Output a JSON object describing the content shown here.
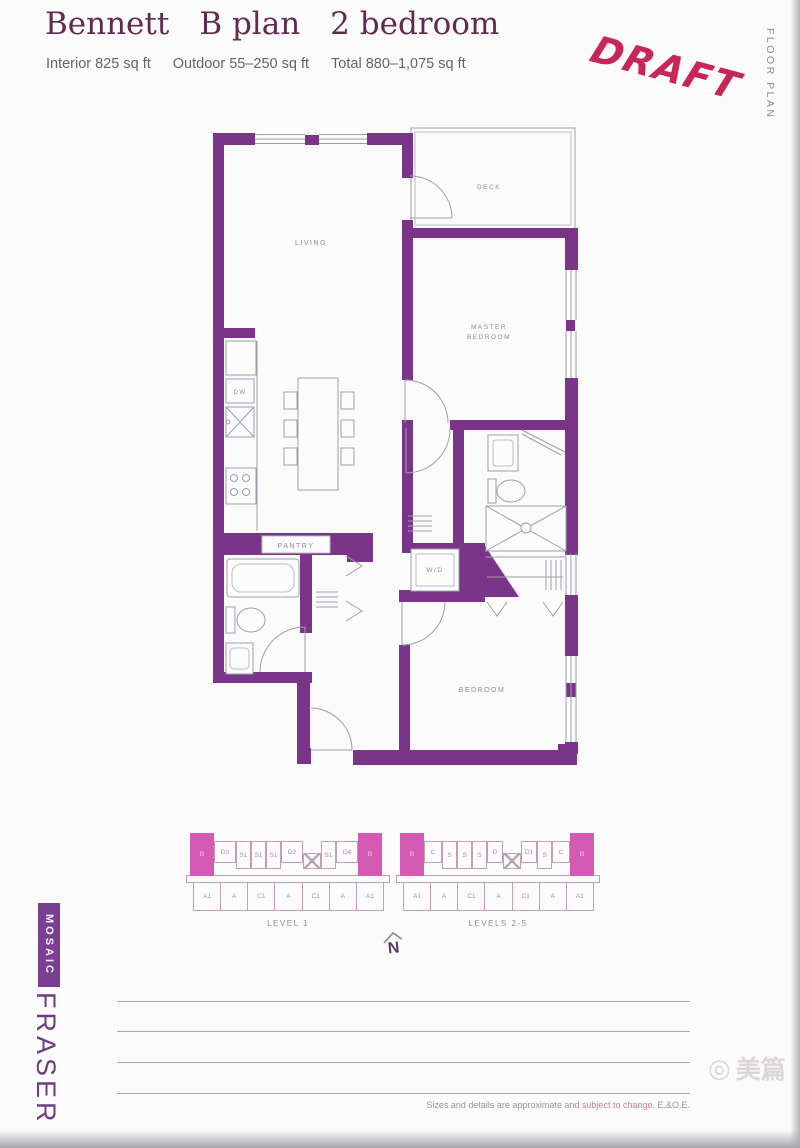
{
  "header": {
    "name": "Bennett",
    "plan": "B plan",
    "type": "2 bedroom",
    "interior": "Interior 825 sq ft",
    "outdoor": "Outdoor 55–250 sq ft",
    "total": "Total 880–1,075 sq ft"
  },
  "stamp": {
    "text": "DRAFT"
  },
  "side_label": "FLOOR PLAN",
  "colors": {
    "wall": "#7b3588",
    "highlight_unit": "#d45ab4",
    "stamp": "#c2184a",
    "brand_box": "#7b3f92",
    "title": "#612a50"
  },
  "floor_plan": {
    "rooms": {
      "living": "LIVING",
      "deck": "DECK",
      "master_line1": "MASTER",
      "master_line2": "BEDROOM",
      "bedroom": "BEDROOM",
      "pantry": "PANTRY",
      "washer_dryer": "W/D",
      "dishwasher": "DW"
    }
  },
  "levels": [
    {
      "label": "LEVEL 1",
      "top": [
        {
          "l": "B",
          "hl": true,
          "w": 24
        },
        {
          "l": "D3",
          "w": 22,
          "h": 22
        },
        {
          "l": "S1",
          "w": 15,
          "h": 28
        },
        {
          "l": "S1",
          "w": 15,
          "h": 28
        },
        {
          "l": "S1",
          "w": 15,
          "h": 28
        },
        {
          "l": "D2",
          "w": 22,
          "h": 22
        },
        {
          "l": "",
          "core": true,
          "w": 18
        },
        {
          "l": "S1",
          "w": 15,
          "h": 28
        },
        {
          "l": "D4",
          "w": 22,
          "h": 22
        },
        {
          "l": "B",
          "hl": true,
          "w": 24
        }
      ],
      "bottom": [
        {
          "l": "A1"
        },
        {
          "l": "A"
        },
        {
          "l": "C1"
        },
        {
          "l": "A"
        },
        {
          "l": "C1"
        },
        {
          "l": "A"
        },
        {
          "l": "A1"
        }
      ]
    },
    {
      "label": "LEVELS 2-5",
      "top": [
        {
          "l": "B",
          "hl": true,
          "w": 24
        },
        {
          "l": "C",
          "w": 18,
          "h": 22
        },
        {
          "l": "S",
          "w": 15,
          "h": 28
        },
        {
          "l": "S",
          "w": 15,
          "h": 28
        },
        {
          "l": "S",
          "w": 15,
          "h": 28
        },
        {
          "l": "D",
          "w": 16,
          "h": 22
        },
        {
          "l": "",
          "core": true,
          "w": 18
        },
        {
          "l": "D1",
          "w": 16,
          "h": 22
        },
        {
          "l": "S",
          "w": 15,
          "h": 28
        },
        {
          "l": "C",
          "w": 18,
          "h": 22
        },
        {
          "l": "B",
          "hl": true,
          "w": 24
        }
      ],
      "bottom": [
        {
          "l": "A1"
        },
        {
          "l": "A"
        },
        {
          "l": "C1"
        },
        {
          "l": "A"
        },
        {
          "l": "C1"
        },
        {
          "l": "A"
        },
        {
          "l": "A1"
        }
      ]
    }
  ],
  "compass": {
    "label": "N"
  },
  "brand": {
    "mosaic": "MOSAIC",
    "fraser": "FRASER"
  },
  "disclaimer": {
    "part1": "Sizes and details are approximate and ",
    "part2": "subject to change.",
    "part3": " E.&O.E."
  },
  "watermark": {
    "text": "美篇"
  }
}
